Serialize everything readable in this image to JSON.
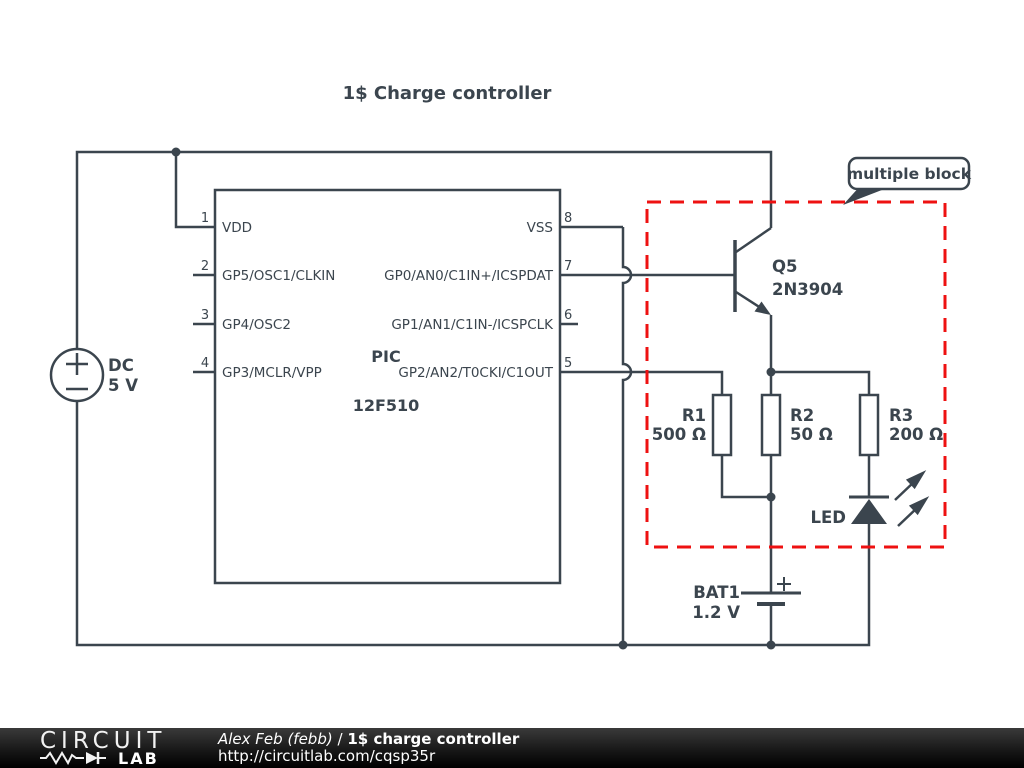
{
  "title": "1$ Charge controller",
  "colors": {
    "wire": "#3b454e",
    "highlight_red": "#ee1111",
    "footer_bg": "#111111",
    "text": "#3b454e"
  },
  "ic": {
    "name_line1": "PIC",
    "name_line2": "12F510",
    "left_pins": [
      {
        "num": "1",
        "label": "VDD"
      },
      {
        "num": "2",
        "label": "GP5/OSC1/CLKIN"
      },
      {
        "num": "3",
        "label": "GP4/OSC2"
      },
      {
        "num": "4",
        "label": "GP3/MCLR/VPP"
      }
    ],
    "right_pins": [
      {
        "num": "8",
        "label": "VSS"
      },
      {
        "num": "7",
        "label": "GP0/AN0/C1IN+/ICSPDAT"
      },
      {
        "num": "6",
        "label": "GP1/AN1/C1IN-/ICSPCLK"
      },
      {
        "num": "5",
        "label": "GP2/AN2/T0CKI/C1OUT"
      }
    ]
  },
  "source": {
    "name": "DC",
    "value": "5 V"
  },
  "transistor": {
    "name": "Q5",
    "part": "2N3904"
  },
  "resistors": [
    {
      "name": "R1",
      "value": "500 Ω"
    },
    {
      "name": "R2",
      "value": "50 Ω"
    },
    {
      "name": "R3",
      "value": "200 Ω"
    }
  ],
  "led": {
    "label": "LED"
  },
  "battery": {
    "name": "BAT1",
    "value": "1.2 V"
  },
  "annotation": {
    "label": "multiple block"
  },
  "footer": {
    "logo_top": "CIRCUIT",
    "logo_bottom": "LAB",
    "author": "Alex Feb (febb)",
    "separator": "/",
    "project": "1$ charge controller",
    "url": "http://circuitlab.com/cqsp35r"
  }
}
